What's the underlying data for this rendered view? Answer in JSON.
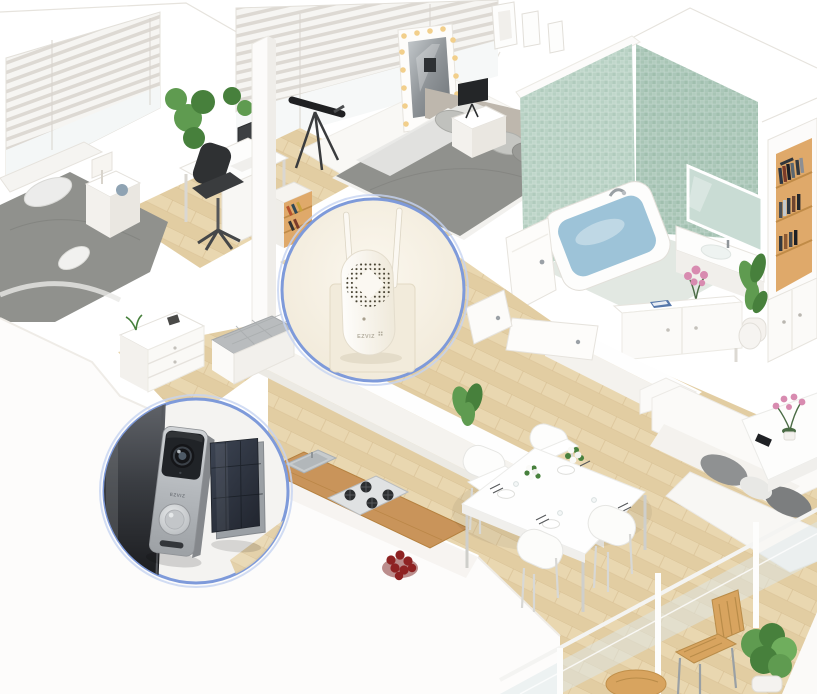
{
  "colors": {
    "background": "#ffffff",
    "wall": "#fcfbfa",
    "wall_shade": "#efede9",
    "wall_edge": "#e0ddd6",
    "floor_wood": "#e8d5ad",
    "floor_wood_dark": "#dcc499",
    "plank_line": "#d2b88a",
    "counter_wood": "#c9945a",
    "tile_green": "#b2cdbf",
    "tile_green_dark": "#a6c4b4",
    "bath_floor": "#e2e8e2",
    "water_blue": "#9dc3d8",
    "fabric_gray": "#90918d",
    "fabric_light": "#c3c4c0",
    "black_accent": "#2b2d2f",
    "plant_green": "#5f9b50",
    "plant_green_dark": "#47803c",
    "accent_blue": "#7e9ada",
    "beige_plate": "#f2ebdb",
    "device_white": "#fbf8f2",
    "silver": "#b9bcc0",
    "silver_dark": "#86898d",
    "panel_dark": "#313845",
    "lens_black": "#141518",
    "berry_red": "#8e2222",
    "flower_pink": "#d88bb0",
    "shelf_wood": "#dfa96a",
    "glass_tint": "#dde8ea",
    "bulb_warm": "#f2cf8b"
  },
  "callouts": {
    "chime": {
      "brand": "EZVIZ"
    },
    "doorbell": {
      "brand": "EZVIZ"
    }
  }
}
